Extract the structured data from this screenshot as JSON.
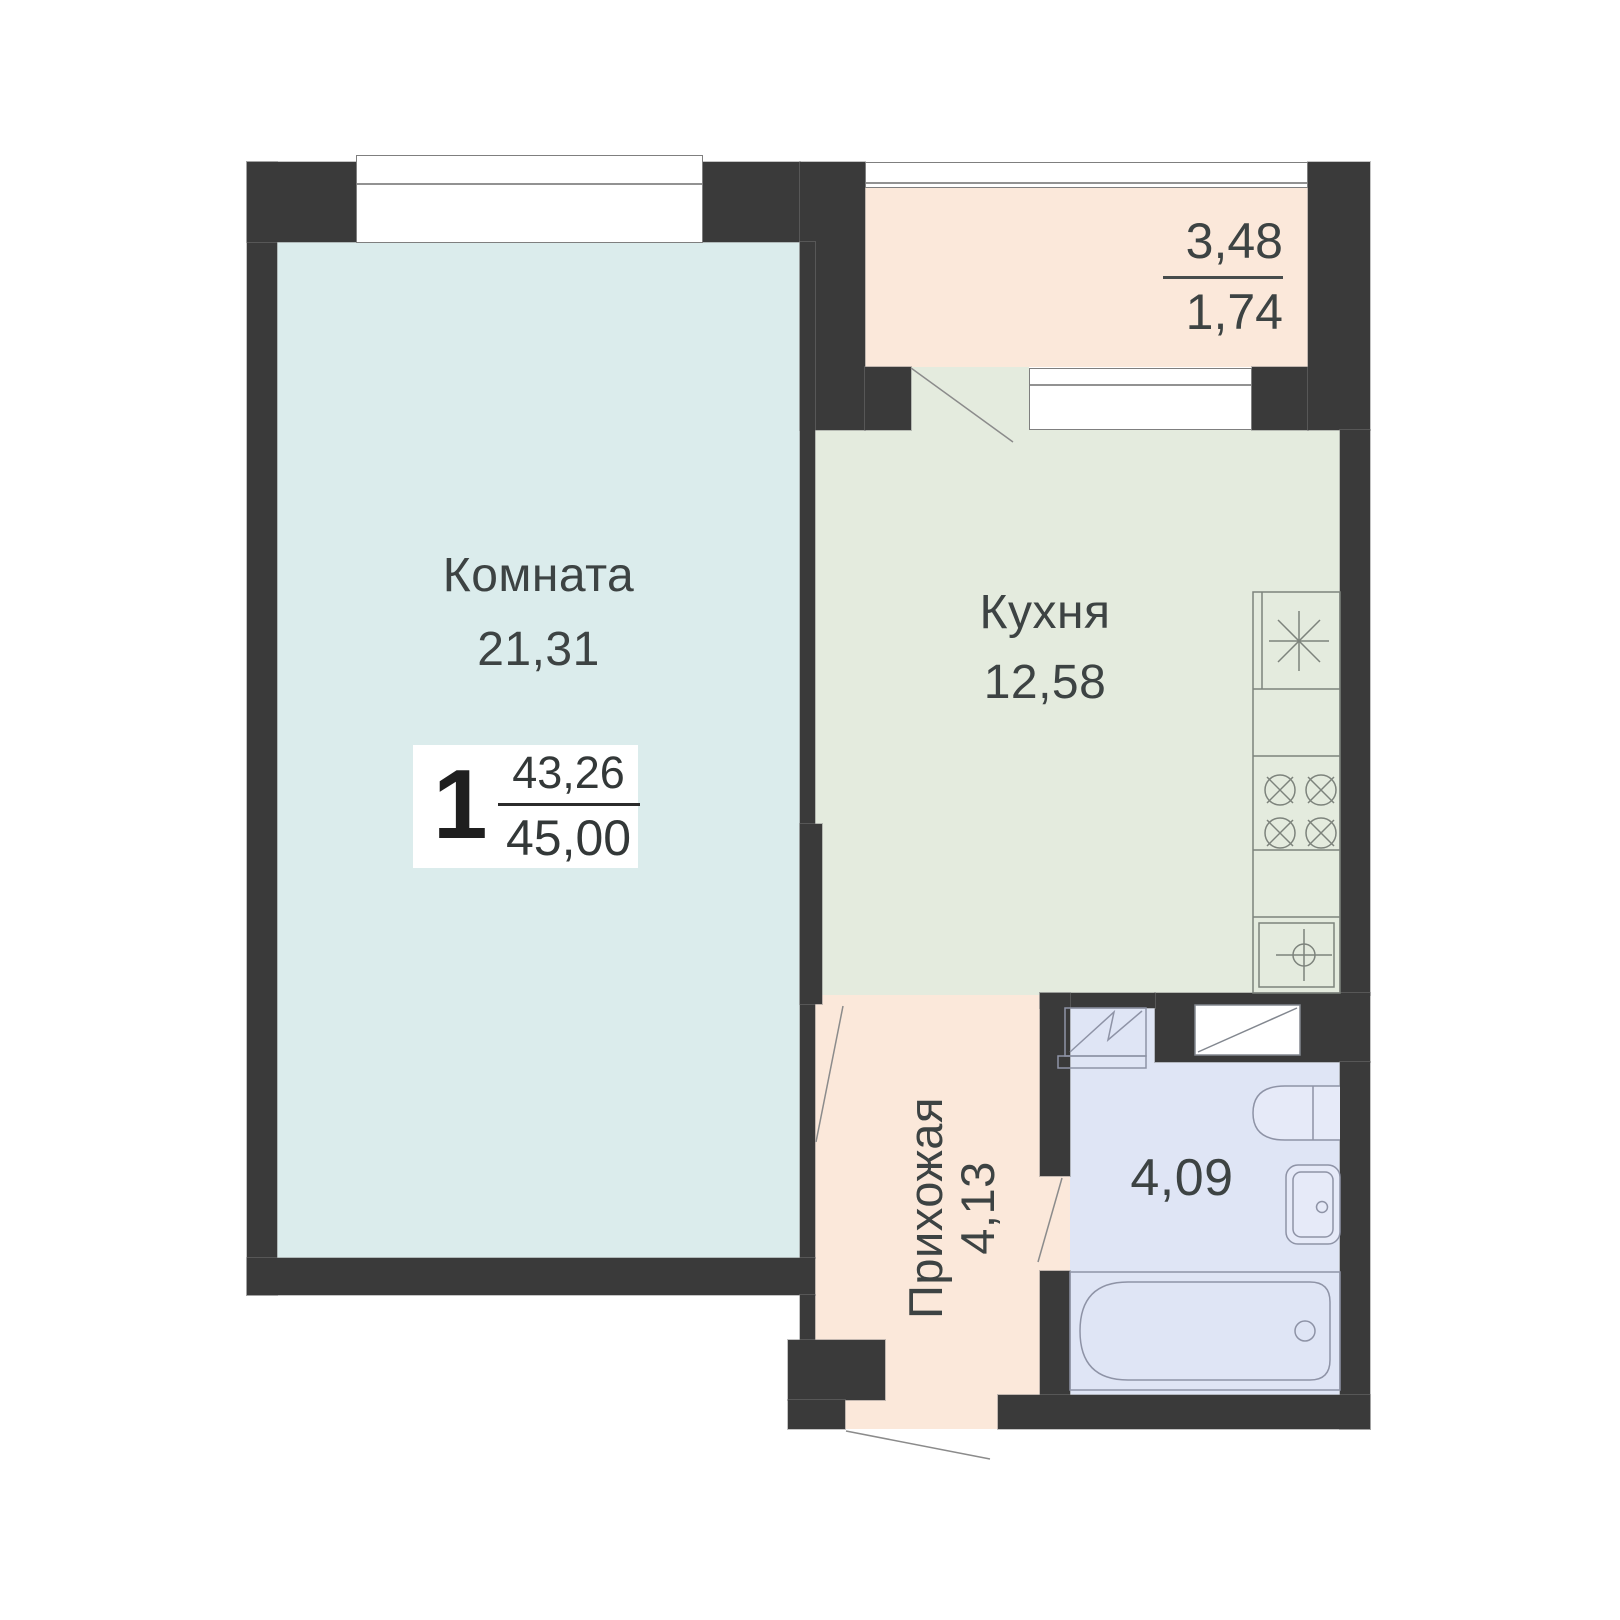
{
  "plan": {
    "rooms": {
      "living": {
        "label": "Комната",
        "area": "21,31"
      },
      "kitchen": {
        "label": "Кухня",
        "area": "12,58"
      },
      "hallway": {
        "label": "Прихожая",
        "area": "4,13"
      },
      "bathroom": {
        "area": "4,09"
      },
      "balcony": {
        "area_total": "3,48",
        "area_reduced": "1,74"
      }
    },
    "summary": {
      "rooms_count": "1",
      "living_area": "43,26",
      "total_area": "45,00"
    },
    "colors": {
      "wall": "#3a3a3a",
      "living_fill": "#dbecec",
      "kitchen_fill": "#e4ebde",
      "hallway_fill": "#fbe8da",
      "balcony_fill": "#fbe8da",
      "bathroom_fill": "#dfe5f5",
      "text": "#3d4343"
    }
  }
}
